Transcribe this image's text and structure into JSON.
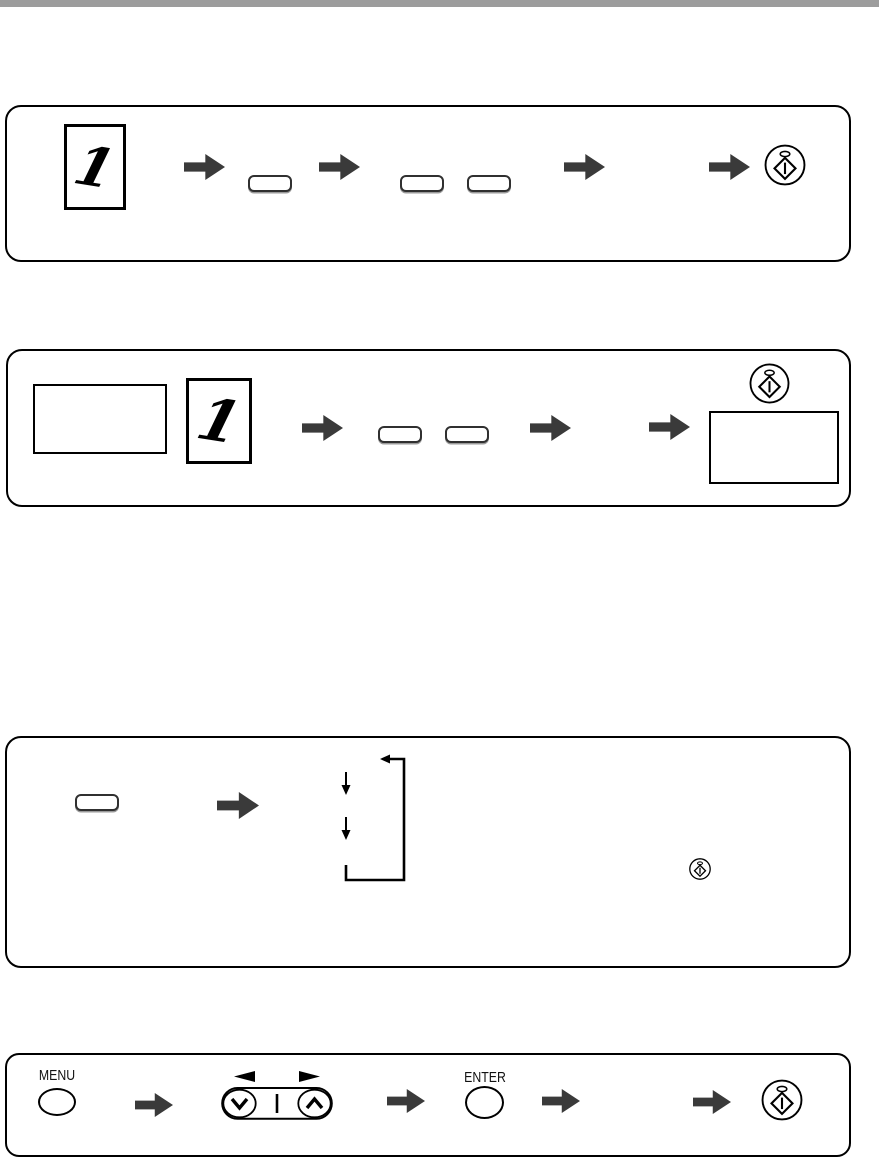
{
  "page": {
    "background": "#ffffff",
    "top_bar_color": "#9c9c9c"
  },
  "colors": {
    "arrow": "#3a3a3a",
    "line": "#000000",
    "top_bar": "#9c9c9c"
  },
  "panel1": {
    "original_label": "1"
  },
  "panel2": {
    "original_label": "1"
  },
  "panel4": {
    "menu_label": "MENU",
    "enter_label": "ENTER"
  },
  "icons": {
    "flow_arrow": "solid right block arrow",
    "start_button": "oval key with diamond start symbol and indicator lamp",
    "original_document": "page sheet with handwritten numeral 1",
    "menu_key": "oval key labelled MENU",
    "enter_key": "oval key labelled ENTER",
    "scroll_rocker": "down/up chevron rocker with left/right triangle markers",
    "loop": "repeat cycle with two down arrows and return line"
  }
}
